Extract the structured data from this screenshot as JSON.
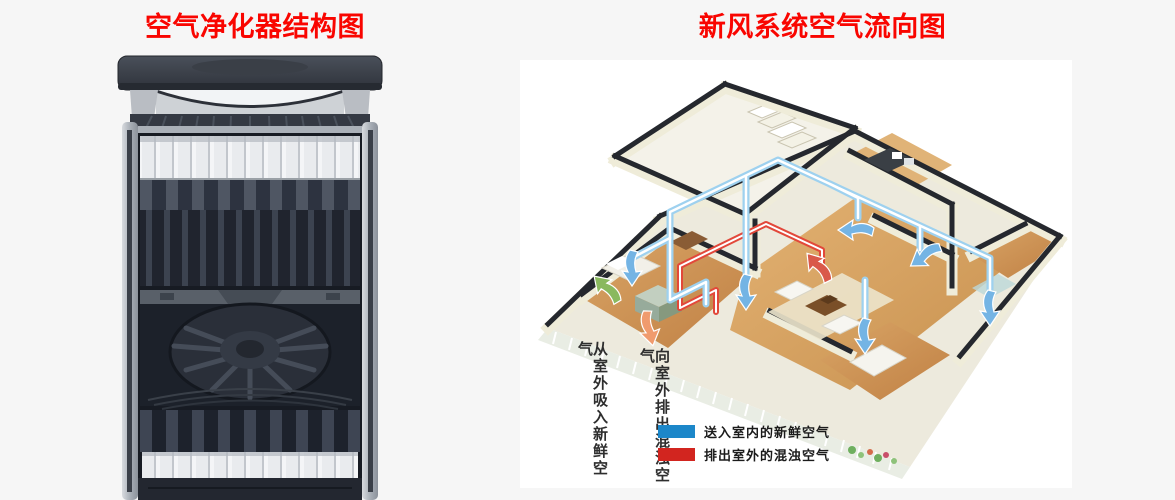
{
  "titles": {
    "left": "空气净化器结构图",
    "right": "新风系统空气流向图"
  },
  "airflow_labels": {
    "intake_vertical": "从室外吸入新鲜空气",
    "exhaust_vertical": "向室外排出混浊空气"
  },
  "legend": {
    "items": [
      {
        "swatch_color": "#1c87c9",
        "label": "送入室内的新鲜空气"
      },
      {
        "swatch_color": "#d2251f",
        "label": "排出室外的混浊空气"
      }
    ]
  },
  "colors": {
    "title_red": "#f90500",
    "page_background": "#f6f6f6",
    "fresh_air_duct": "#9ed1ef",
    "exhaust_duct": "#e2483a",
    "intake_arrow_green": "#8ab95e",
    "exhaust_arrow_orange": "#f09b6e",
    "purifier_body_dark": "#2b303a"
  }
}
